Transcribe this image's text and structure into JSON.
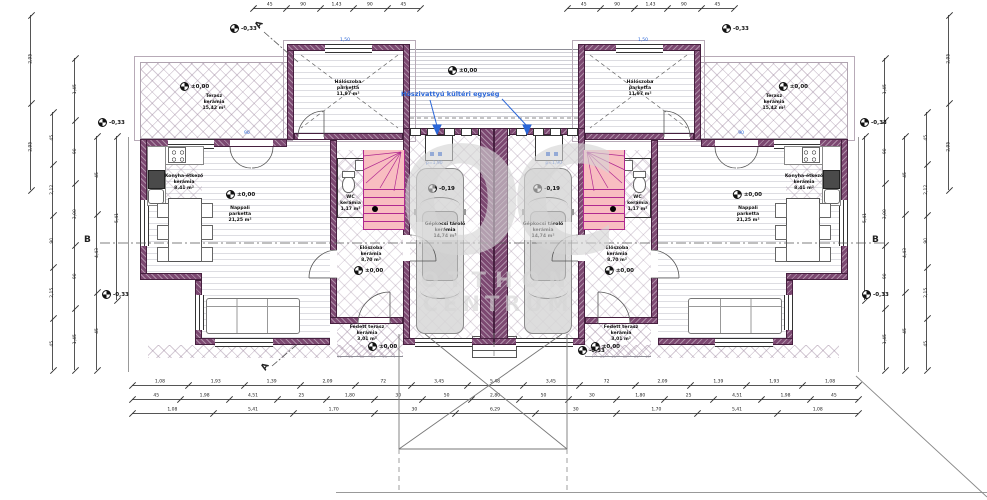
{
  "drawing": {
    "watermark_monogram": "OC",
    "watermark_line1": "OTTHON",
    "watermark_line2": "CENTRUM"
  },
  "annotations": {
    "heat_pump_label": "Hőszivattyú kültéri egység",
    "heat_pump_dim": "p=1,90",
    "section_a": "A",
    "section_b": "B",
    "window_dim_a": "1,50",
    "window_dim_b": "90"
  },
  "levels": {
    "ground_outside": "-0,33",
    "zero": "±0,00",
    "garage": "-0,19"
  },
  "rooms": {
    "terasz": {
      "name": "Terasz",
      "material": "kerámia",
      "area": "15,42 m²"
    },
    "halo": {
      "name": "Hálószoba",
      "material": "parketta",
      "area": "11,97 m²"
    },
    "nappali": {
      "name": "Nappali",
      "material": "parketta",
      "area": "21,25 m²"
    },
    "konyha": {
      "name": "Konyha-étkező",
      "material": "kerámia",
      "area": "8,41 m²"
    },
    "wc": {
      "name": "WC",
      "material": "kerámia",
      "area": "1,17 m²"
    },
    "eloszoba": {
      "name": "Előszoba",
      "material": "kerámia",
      "area": "8,70 m²"
    },
    "fedett": {
      "name": "Fedett terasz",
      "material": "kerámia",
      "area": "3,01 m²"
    },
    "garazs": {
      "name": "Gépkocsi tároló",
      "material": "kerámia",
      "area": "14,74 m²"
    }
  },
  "dimensions": {
    "bottom1": [
      "1,08",
      "1,93",
      "1,39",
      "2,09",
      "72",
      "3,45",
      "5,48",
      "3,45",
      "72",
      "2,09",
      "1,39",
      "1,93",
      "1,08"
    ],
    "bottom2": [
      "45",
      "1,98",
      "4,51",
      "25",
      "1,80",
      "30",
      "50",
      "2,80",
      "50",
      "30",
      "1,80",
      "25",
      "4,51",
      "1,98",
      "45"
    ],
    "bottom3": [
      "1,08",
      "5,41",
      "1,70",
      "30",
      "6,29",
      "30",
      "1,70",
      "5,41",
      "1,08"
    ],
    "top": [
      "45",
      "90",
      "1,43",
      "90",
      "45"
    ],
    "left_a": [
      "2,95",
      "2,95"
    ],
    "left_b": [
      "45",
      "2,12",
      "90",
      "2,15",
      "45"
    ],
    "left_c": [
      "1,45",
      "90",
      "3,00",
      "90",
      "1,45"
    ],
    "left_d": [
      "45",
      "4,43",
      "45"
    ],
    "left_e": [
      "5,41"
    ]
  }
}
